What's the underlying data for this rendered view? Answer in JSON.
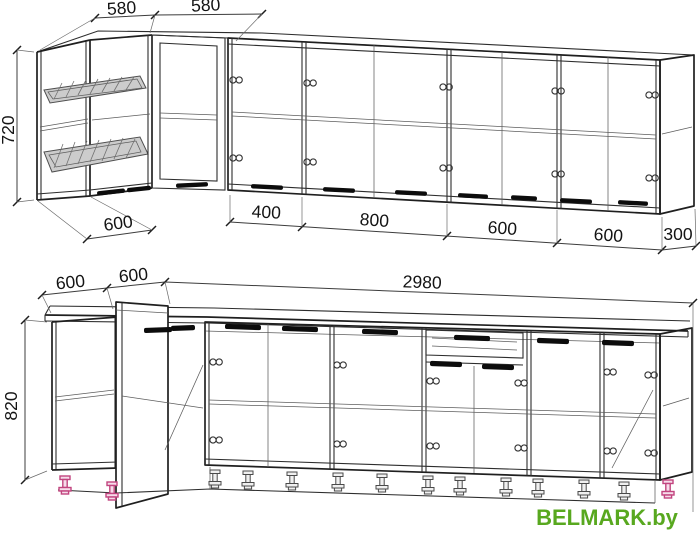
{
  "drawing": {
    "upper_cabinets": {
      "top_width_dims": [
        "580",
        "580"
      ],
      "height_dim": "720",
      "bottom_width_dims": [
        "600",
        "400",
        "800",
        "600",
        "600",
        "300"
      ]
    },
    "base_cabinets": {
      "left_depth_dims": [
        "600",
        "600"
      ],
      "total_width_dim": "2980",
      "height_dim": "820"
    }
  },
  "watermark": {
    "text": "BELMARK.by",
    "color": "#58a81f"
  },
  "colors": {
    "line": "#1f1f1f",
    "feet_accent": "#c2457f",
    "background": "#ffffff"
  }
}
